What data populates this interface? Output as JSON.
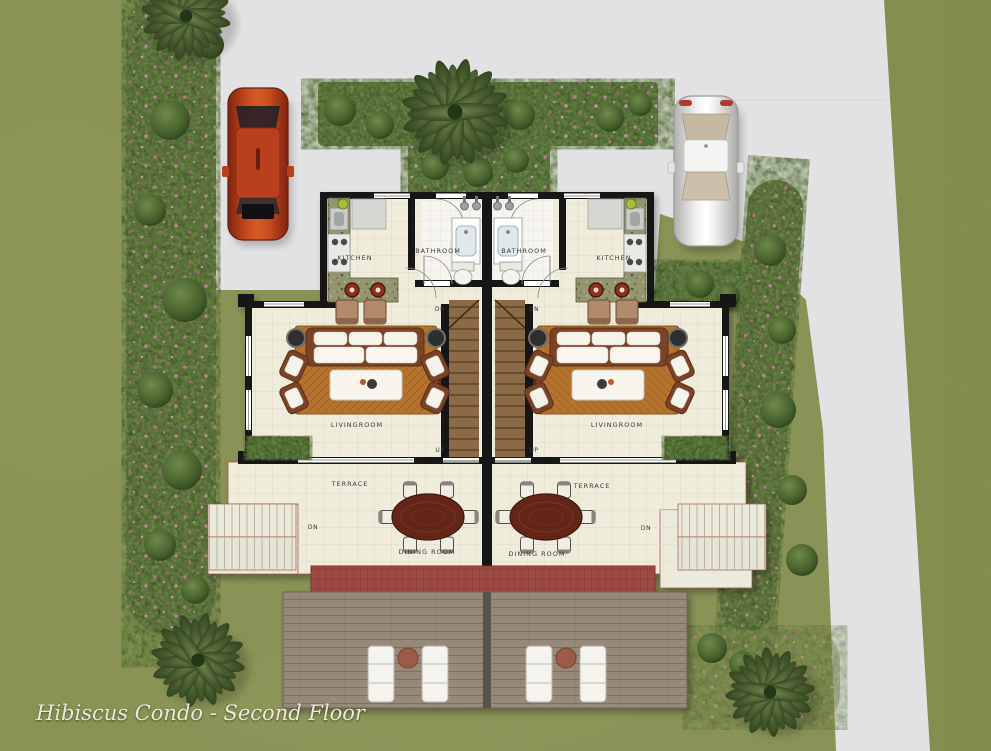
{
  "caption": "Hibiscus Condo - Second Floor",
  "labels": {
    "kitchen": "KITCHEN",
    "bathroom": "BATHROOM",
    "livingroom": "LIVINGROOM",
    "terrace": "TERRACE",
    "dining_room": "DINING ROOM",
    "down": "DN",
    "up": "UP"
  },
  "site_objects": [
    "red-car",
    "white-car",
    "palm-tree-top-left",
    "palm-tree-top-center",
    "palm-tree-bottom-left",
    "palm-tree-bottom-right",
    "hedge-top-bar",
    "entry-garden",
    "left-planting-border",
    "right-planting-strip",
    "driveway",
    "lawn",
    "wood-deck",
    "red-awning",
    "sun-loungers",
    "dining-set",
    "sofa-set",
    "twin-staircase",
    "exterior-stairs"
  ],
  "colors": {
    "grass": "#8d9556",
    "driveway": "#e4e4e6",
    "floor": "#efecdb",
    "bathroom_floor": "#f5f4ee",
    "wall": "#161616",
    "hedge": "#55703c",
    "flower": "#c777a0",
    "rug": "#b4722e",
    "stair_wood": "#8a6a46",
    "dining_table": "#632718",
    "awning": "#9d4b43",
    "deck": "#97897a",
    "granite_counter": "#94956d",
    "car_red": "#c44a1e",
    "car_white": "#e9e9e7",
    "caption_text": "#ece9dc"
  }
}
